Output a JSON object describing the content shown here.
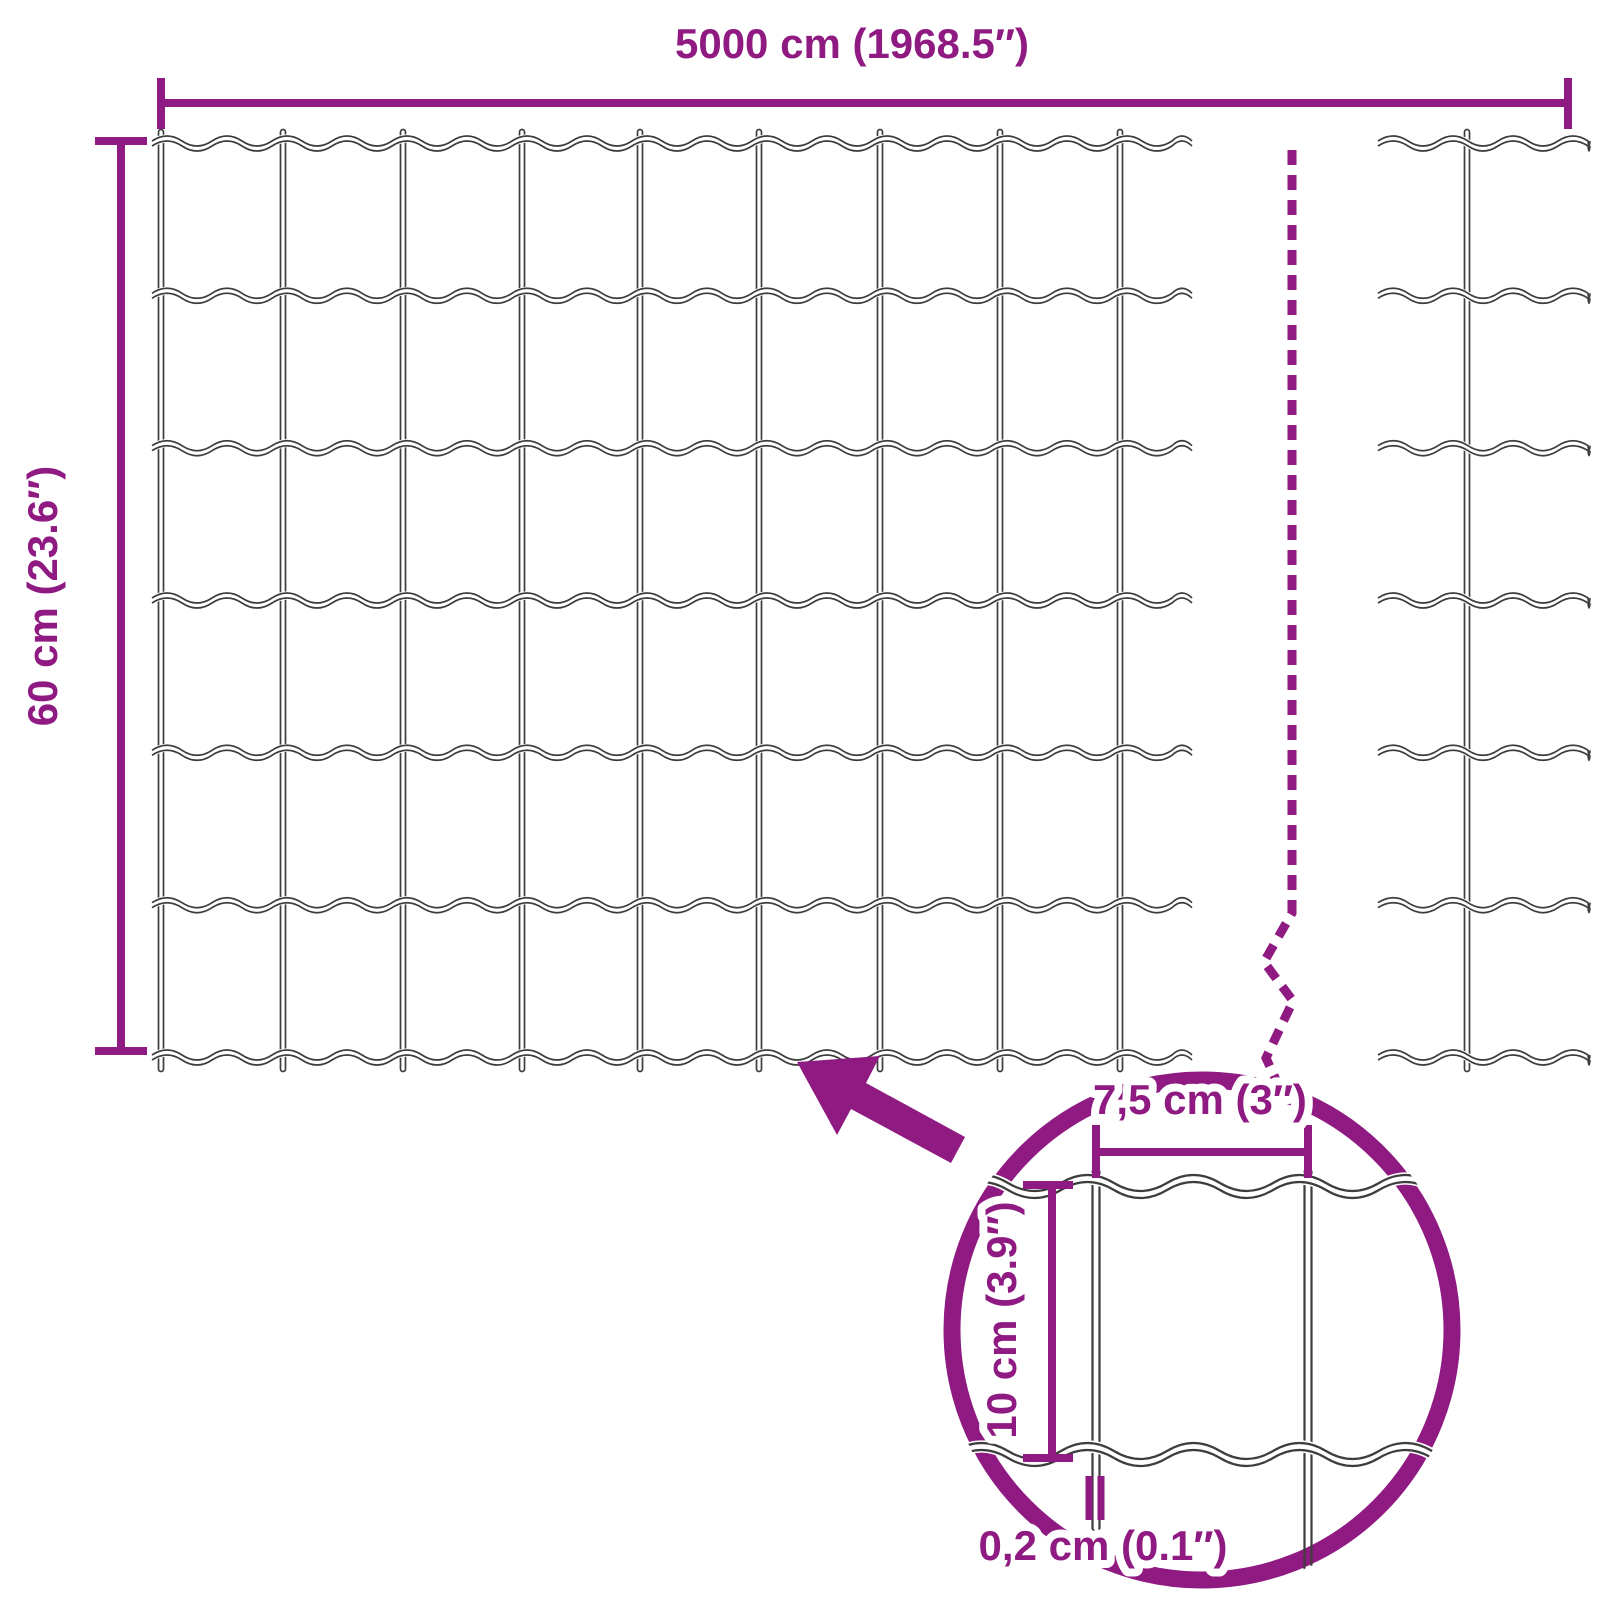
{
  "diagram": {
    "description": "Welded wire mesh fence roll dimension diagram",
    "colors": {
      "accent": "#8f1a82",
      "wire": "#3d3d3d",
      "background": "#ffffff"
    },
    "labels": {
      "roll_length": "5000 cm (1968.5″)",
      "roll_height": "60 cm (23.6″)",
      "mesh_width": "7,5 cm (3″)",
      "mesh_height": "10 cm (3.9″)",
      "wire_thickness": "0,2 cm (0.1″)"
    },
    "mesh": {
      "rows": 6,
      "columns": 9
    }
  }
}
